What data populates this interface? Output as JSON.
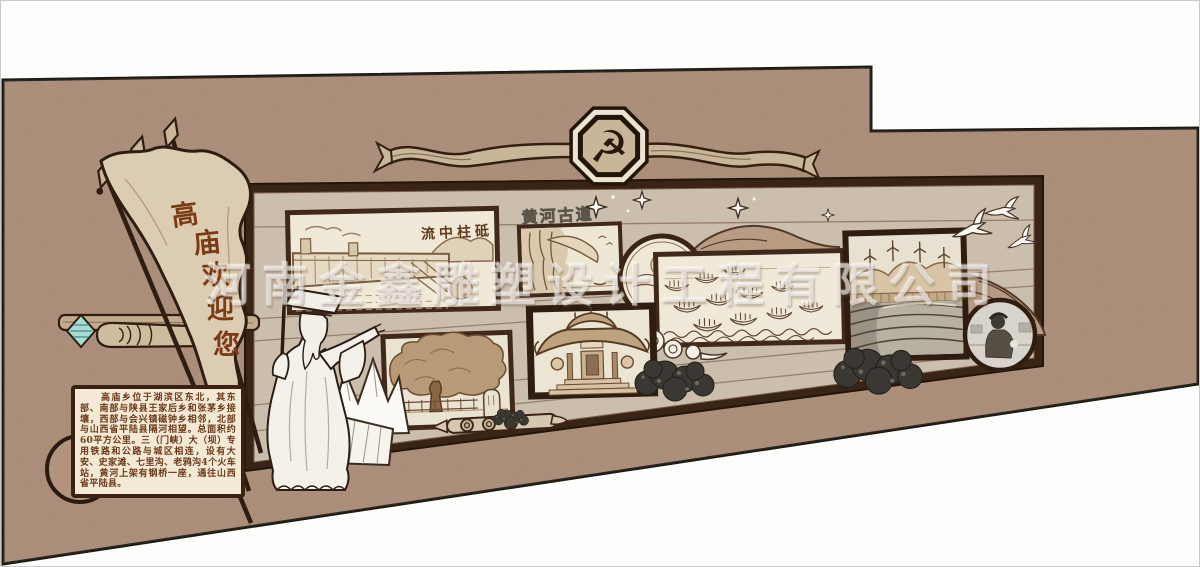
{
  "watermark": {
    "text": "河南金鑫雕塑设计工程有限公司"
  },
  "emblem": {
    "symbol": "☭"
  },
  "flag": {
    "text": "高庙欢迎您",
    "chars": [
      "高",
      "庙",
      "欢",
      "迎",
      "您"
    ]
  },
  "gallery": {
    "dam_caption": "流中柱砥",
    "gorge_title": "黄河古道"
  },
  "infobox": {
    "text": "　　高庙乡位于湖滨区东北，其东部、南部与陕县王家后乡和张茅乡接壤，西部与会兴镇磁钟乡相邻，北部与山西省平陆县隔河相望。总面积约60平方公里。三（门峡）大（坝）专用铁路和公路与城区相连，设有大安、史家滩、七里沟、老鸦沟4个火车站，黄河上架有钢桥一座，通往山西省平陆县。"
  },
  "colors": {
    "wall": "#a98a74",
    "panel": "#cbbead",
    "frame": "#40291a",
    "cream": "#f0e9d8",
    "teal_accent": "#a8ddd4"
  }
}
